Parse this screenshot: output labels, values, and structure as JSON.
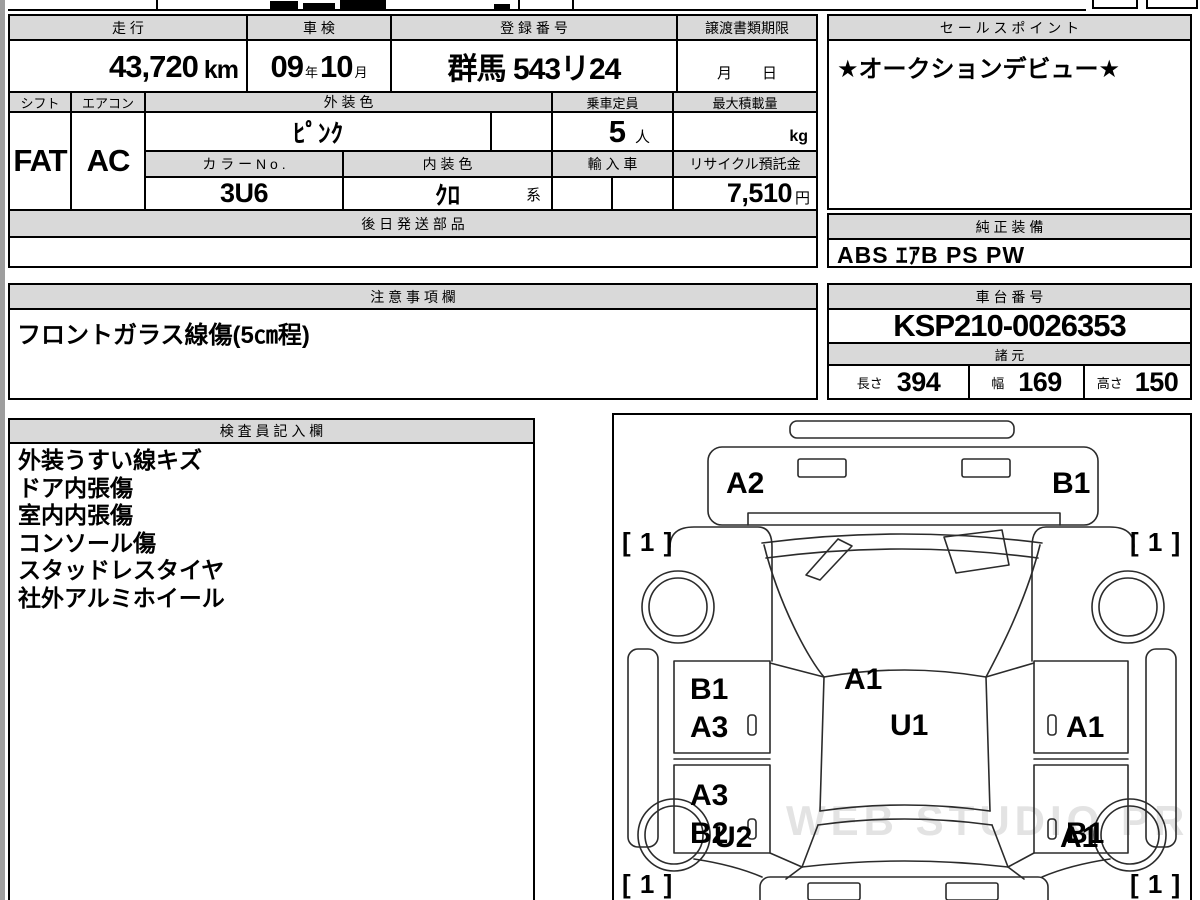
{
  "top": {
    "mileage": {
      "label": "走 行",
      "value": "43,720",
      "unit": "km"
    },
    "inspection": {
      "label": "車 検",
      "year": "09",
      "year_u": "年",
      "month": "10",
      "month_u": "月"
    },
    "registration": {
      "label": "登 録 番 号",
      "value": "群馬 543リ24"
    },
    "transfer": {
      "label": "譲渡書類期限",
      "value": "月　　日"
    },
    "shift": {
      "label": "シフト",
      "value": "FAT"
    },
    "aircon": {
      "label": "エアコン",
      "value": "AC"
    },
    "ext_color": {
      "label": "外 装 色",
      "value": "ﾋﾟﾝｸ"
    },
    "capacity": {
      "label": "乗車定員",
      "value": "5",
      "unit": "人"
    },
    "max_load": {
      "label": "最大積載量",
      "unit": "kg"
    },
    "color_no": {
      "label": "カ ラ ー N o .",
      "value": "3U6"
    },
    "int_color": {
      "label": "内 装 色",
      "value": "ｸﾛ",
      "suffix": "系"
    },
    "import_car": {
      "label": "輸 入 車"
    },
    "recycle": {
      "label": "リサイクル預託金",
      "value": "7,510",
      "unit": "円"
    },
    "later_parts": {
      "label": "後 日 発 送 部 品",
      "value": ""
    }
  },
  "sales": {
    "label": "セ ー ル ス ポ イ ン ト",
    "value": "★オークションデビュー★"
  },
  "genuine": {
    "label": "純 正 装 備",
    "value": "ABS ｴｱB PS PW"
  },
  "caution": {
    "label": "注 意 事 項 欄",
    "value": "フロントガラス線傷(5㎝程)"
  },
  "chassis": {
    "label": "車 台 番 号",
    "value": "KSP210-0026353"
  },
  "specs": {
    "label": "諸 元",
    "l_label": "長さ",
    "l_value": "394",
    "w_label": "幅",
    "w_value": "169",
    "h_label": "高さ",
    "h_value": "150"
  },
  "inspector": {
    "label": "検 査 員 記 入 欄",
    "lines": [
      "外装うすい線キズ",
      "ドア内張傷",
      "室内内張傷",
      "コンソール傷",
      "スタッドレスタイヤ",
      "社外アルミホイール"
    ]
  },
  "diagram": {
    "watermark": "WEB STUDIO PRO",
    "labels": {
      "front_bumper_left": "A2",
      "front_bumper_right": "B1",
      "tire_front_left": "[ 1 ]",
      "tire_front_right": "[ 1 ]",
      "hood": "A1",
      "front_door_left_upper": "B1",
      "front_door_left_lower": "A3",
      "roof": "U1",
      "front_door_right": "A1",
      "rear_door_left_upper": "A3",
      "rear_door_left_lower": "B2",
      "rear_door_right": "B1",
      "rear_quarter_left": "U2",
      "rear_quarter_right": "A1",
      "tire_rear_left": "[ 1 ]",
      "tire_rear_right": "[ 1 ]"
    }
  }
}
